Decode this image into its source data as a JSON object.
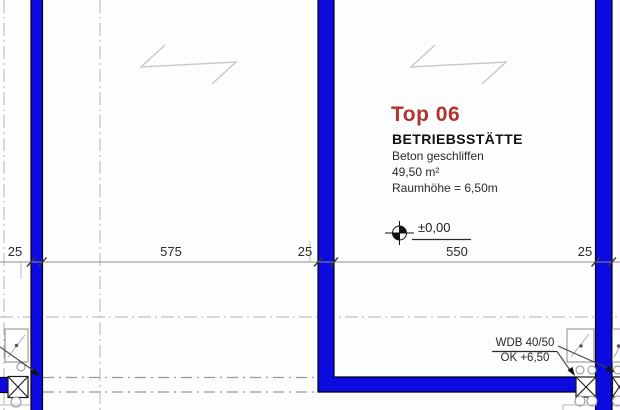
{
  "colors": {
    "wall": "#0b0bdf",
    "accent": "#b2322f",
    "text": "#1f1f1f"
  },
  "unit": {
    "title": "Top 06",
    "type": "BETRIEBSSTÄTTE",
    "finish": "Beton geschliffen",
    "area": "49,50 m²",
    "room_height": "Raumhöhe = 6,50m"
  },
  "level_marker": {
    "label": "±0,00"
  },
  "wdb_note": {
    "line1": "WDB 40/50",
    "line2": "OK +6,50"
  },
  "dimensions": {
    "labels": [
      "25",
      "575",
      "25",
      "550",
      "25"
    ]
  }
}
